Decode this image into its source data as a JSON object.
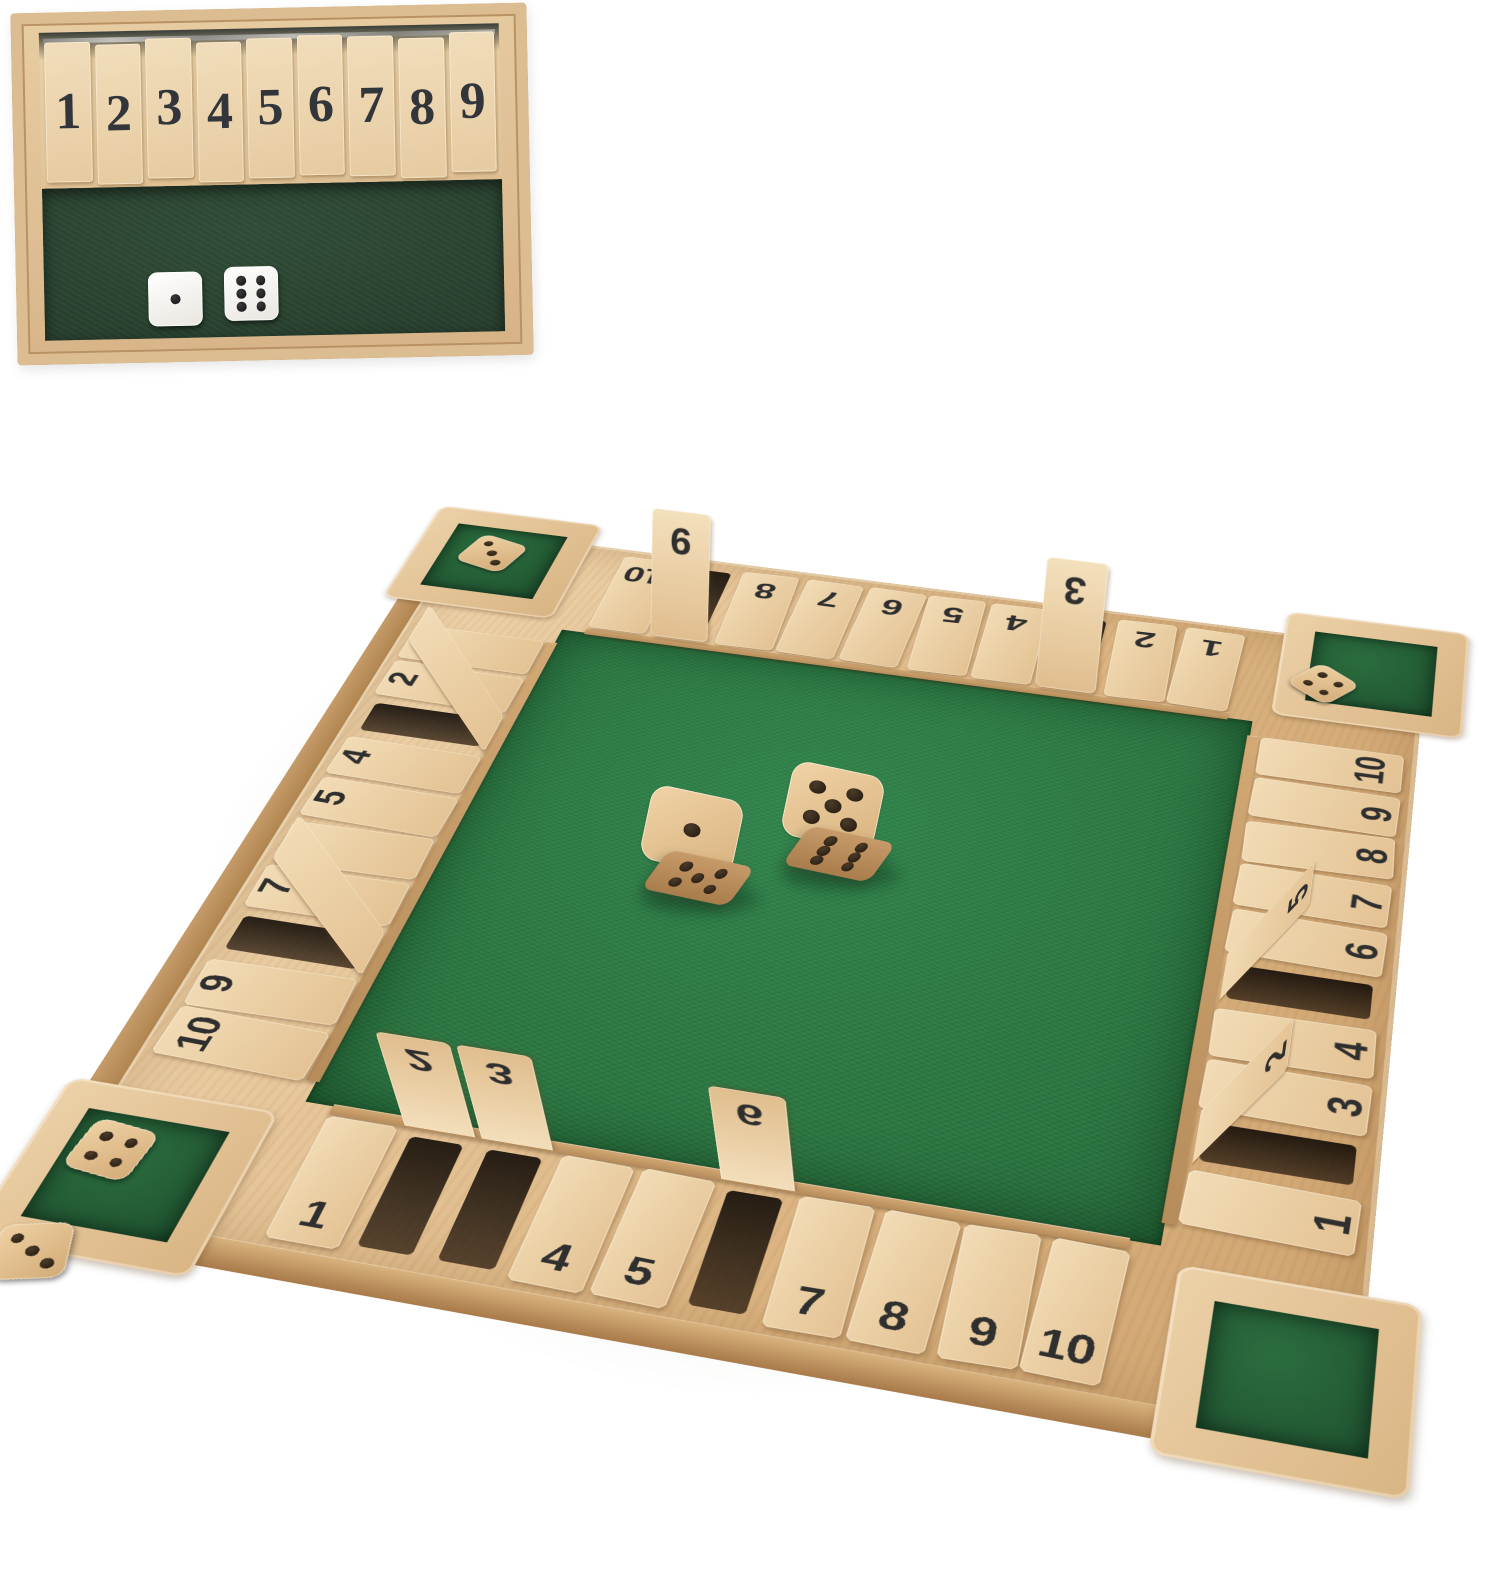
{
  "colors": {
    "background": "#ffffff",
    "wood_light": "#f0d9b4",
    "wood_mid": "#e2c193",
    "wood_frame": "#dcb988",
    "wood_dark": "#b98e5f",
    "felt_green": "#2f8048",
    "felt_green_dark": "#215e33",
    "felt_inset": "#2b4331",
    "number_ink": "#2f2f2f",
    "pip_wood_die": "#33261a",
    "pip_white_die": "#1c1c1c",
    "die_white": "#f7f5f0"
  },
  "inset": {
    "tiles": [
      {
        "label": "1"
      },
      {
        "label": "2"
      },
      {
        "label": "3"
      },
      {
        "label": "4"
      },
      {
        "label": "5"
      },
      {
        "label": "6"
      },
      {
        "label": "7"
      },
      {
        "label": "8"
      },
      {
        "label": "9"
      }
    ],
    "dice": [
      {
        "top": 1
      },
      {
        "top": 6
      }
    ]
  },
  "board": {
    "top_row": {
      "tiles": [
        {
          "label": "10",
          "raised": false
        },
        {
          "label": "9",
          "raised": true
        },
        {
          "label": "8",
          "raised": false
        },
        {
          "label": "7",
          "raised": false
        },
        {
          "label": "6",
          "raised": false
        },
        {
          "label": "5",
          "raised": false
        },
        {
          "label": "4",
          "raised": false
        },
        {
          "label": "3",
          "raised": true
        },
        {
          "label": "2",
          "raised": false
        },
        {
          "label": "1",
          "raised": false
        }
      ]
    },
    "left_col": {
      "tiles": [
        {
          "label": "1",
          "raised": false
        },
        {
          "label": "2",
          "raised": false
        },
        {
          "label": "3",
          "raised": true
        },
        {
          "label": "4",
          "raised": false
        },
        {
          "label": "5",
          "raised": false
        },
        {
          "label": "6",
          "raised": false
        },
        {
          "label": "7",
          "raised": false
        },
        {
          "label": "8",
          "raised": true
        },
        {
          "label": "9",
          "raised": false
        },
        {
          "label": "10",
          "raised": false
        }
      ]
    },
    "right_col": {
      "tiles": [
        {
          "label": "10",
          "raised": false
        },
        {
          "label": "9",
          "raised": false
        },
        {
          "label": "8",
          "raised": false
        },
        {
          "label": "7",
          "raised": false
        },
        {
          "label": "6",
          "raised": false
        },
        {
          "label": "5",
          "raised": true
        },
        {
          "label": "4",
          "raised": false
        },
        {
          "label": "3",
          "raised": false
        },
        {
          "label": "2",
          "raised": true
        },
        {
          "label": "1",
          "raised": false
        }
      ]
    },
    "bottom_row": {
      "tiles": [
        {
          "label": "1",
          "raised": false
        },
        {
          "label": "2",
          "raised": true
        },
        {
          "label": "3",
          "raised": true
        },
        {
          "label": "4",
          "raised": false
        },
        {
          "label": "5",
          "raised": false
        },
        {
          "label": "6",
          "raised": true
        },
        {
          "label": "7",
          "raised": false
        },
        {
          "label": "8",
          "raised": false
        },
        {
          "label": "9",
          "raised": false
        },
        {
          "label": "10",
          "raised": false
        }
      ]
    },
    "center_dice": [
      {
        "top": 1,
        "front": 5
      },
      {
        "top": 5,
        "front": 6
      }
    ],
    "corner_dice": {
      "top_left": [
        {
          "top": 3
        }
      ],
      "top_right": [
        {
          "top": 4
        }
      ],
      "bottom_left": [
        {
          "top": 4
        },
        {
          "top": 3
        }
      ],
      "bottom_right": []
    }
  }
}
